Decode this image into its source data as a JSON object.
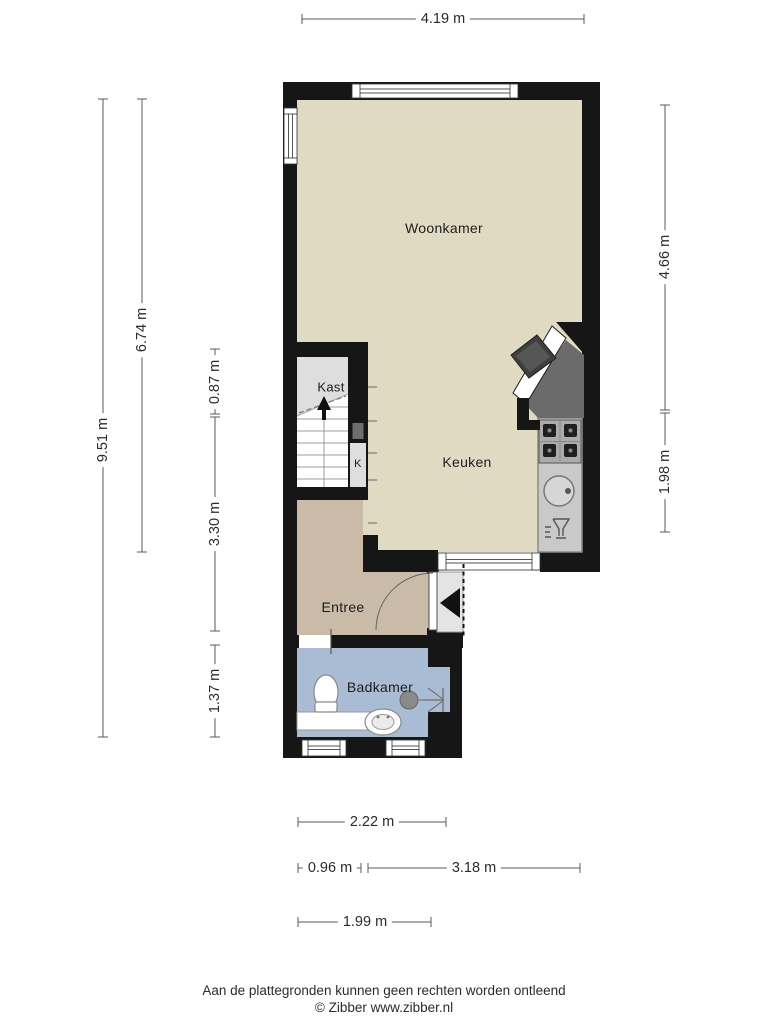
{
  "meta": {
    "type": "floorplan",
    "language": "nl",
    "provider": "Zibber"
  },
  "rooms": {
    "woonkamer": "Woonkamer",
    "keuken": "Keuken",
    "kast": "Kast",
    "kast_k": "K",
    "entree": "Entree",
    "badkamer": "Badkamer"
  },
  "dimensions": {
    "top_width": "4.19 m",
    "left_total": "9.51 m",
    "left_upper": "6.74 m",
    "left_kast": "0.87 m",
    "left_stairs": "3.30 m",
    "left_bath": "1.37 m",
    "right_upper": "4.66 m",
    "right_lower": "1.98 m",
    "bottom_bath": "2.22 m",
    "bottom_entree": "0.96 m",
    "bottom_keuken": "3.18 m",
    "bottom_lower": "1.99 m"
  },
  "footer": {
    "disclaimer": "Aan de plattegronden kunnen geen rechten worden ontleend",
    "copyright": "© Zibber www.zibber.nl"
  },
  "colors": {
    "wall": "#161616",
    "floor_main": "#e1dac2",
    "floor_entree": "#c9bba7",
    "floor_bath": "#a9bcd3",
    "floor_closet": "#dedede",
    "counter": "#c9c9c9",
    "dark_fixture": "#6b6b6b",
    "dimension_line": "#5a5a5a"
  },
  "icons": [
    "stairs-up-arrow-icon",
    "entrance-arrow-icon",
    "door-swing-icon",
    "window-icon",
    "toilet-icon",
    "washbasin-icon",
    "shower-drain-icon",
    "bath-counter-icon",
    "stove-icon",
    "kitchen-sink-icon",
    "dishwasher-icon"
  ]
}
